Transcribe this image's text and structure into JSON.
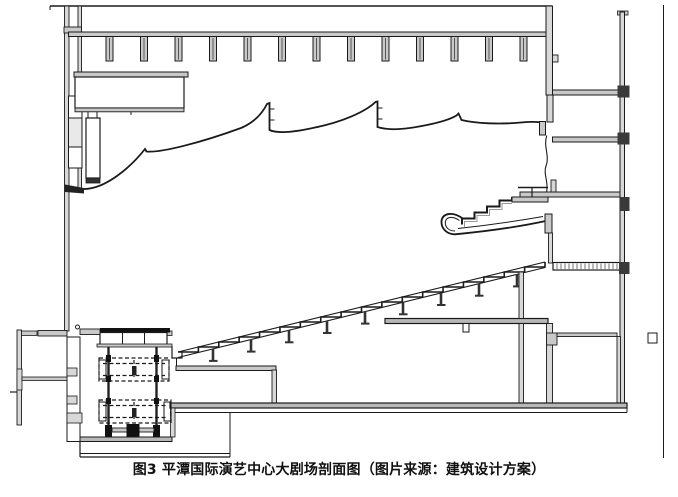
{
  "page": {
    "background": "#ffffff"
  },
  "figure": {
    "caption": "图3 平潭国际演艺中心大剧场剖面图（图片来源：建筑设计方案）",
    "caption_color": "#111111",
    "drawing": {
      "type": "architectural-section",
      "subject": "theater-longitudinal-section",
      "line_color": "#1a1a1a",
      "fill_light": "#c9c9c9",
      "fill_mid": "#d8d8d8",
      "fill_dark": "#111111",
      "background": "#ffffff"
    }
  }
}
